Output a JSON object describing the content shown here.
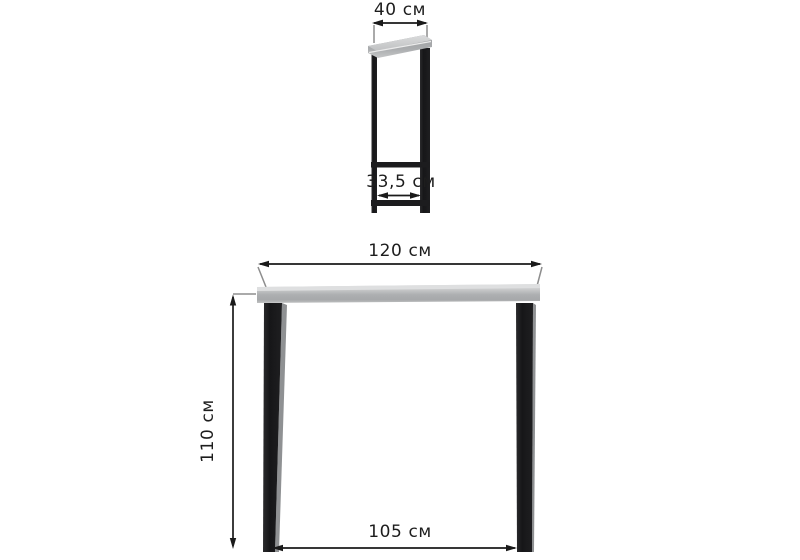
{
  "diagram": {
    "type": "furniture-dimension-drawing",
    "views": {
      "side": {
        "labels": {
          "top_depth": "40 см",
          "base_span": "33,5 см"
        }
      },
      "front": {
        "labels": {
          "top_width": "120 см",
          "height": "110 см",
          "leg_span": "105 см"
        }
      }
    },
    "colors": {
      "background": "#ffffff",
      "dimension_line": "#1a1a1a",
      "extension_line": "#8d8d8d",
      "metal_frame": "#1b1b1d",
      "tabletop_light": "#d9dadb",
      "tabletop_shade": "#a4a6a8"
    }
  }
}
